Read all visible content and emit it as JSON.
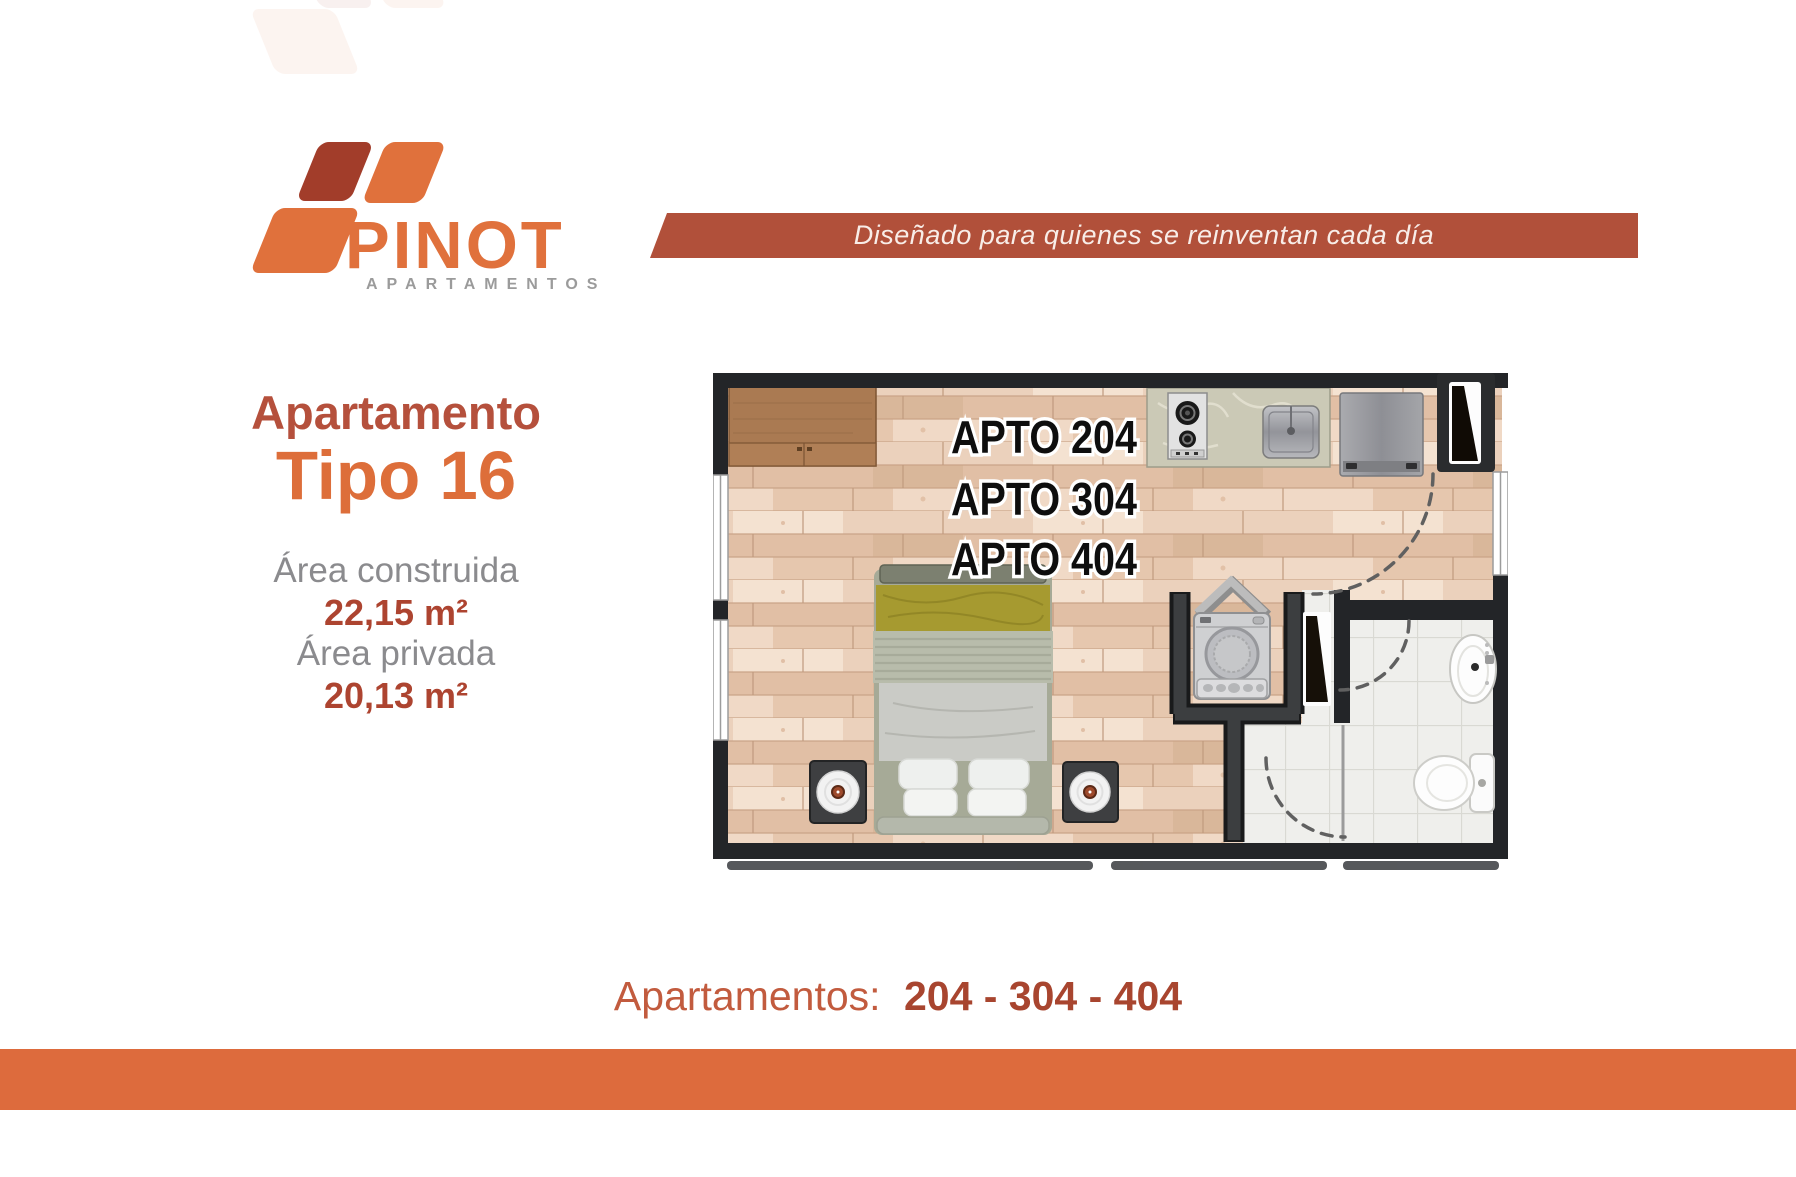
{
  "logo": {
    "brand": "PINOT",
    "subtitle": "APARTAMENTOS"
  },
  "banner": {
    "tagline": "Diseñado para quienes se reinventan cada día",
    "bg_color": "#b1503a"
  },
  "info": {
    "title_top": "Apartamento",
    "title_bottom": "Tipo 16",
    "area_construida_label": "Área construida",
    "area_construida_value": "22,15 m²",
    "area_privada_label": "Área privada",
    "area_privada_value": "20,13 m²"
  },
  "floorplan": {
    "unit_labels": [
      "APTO 204",
      "APTO 304",
      "APTO 404"
    ],
    "features": [
      "wardrobe-cabinet",
      "kitchen-counter",
      "cooktop",
      "kitchen-sink",
      "fridge",
      "entry-door",
      "door-swing-arc",
      "windows",
      "double-bed",
      "pillows",
      "nightstand-left",
      "nightstand-right",
      "laundry-closet",
      "washing-machine",
      "bifold-doors",
      "bathroom",
      "bathroom-sink",
      "toilet",
      "shower-area",
      "glass-partition"
    ]
  },
  "footer": {
    "label": "Apartamentos:",
    "units": "204 - 304 - 404"
  },
  "colors": {
    "accent_orange": "#dd6b3d",
    "brick_red": "#b1503a",
    "title_orange": "#dd6e3a",
    "title_brick": "#b5503c",
    "value_red": "#ad4430",
    "gray_text": "#8b8b8e",
    "wall_black": "#232528",
    "wood_floor": "#e8c9b3",
    "tile_floor": "#efefec"
  }
}
